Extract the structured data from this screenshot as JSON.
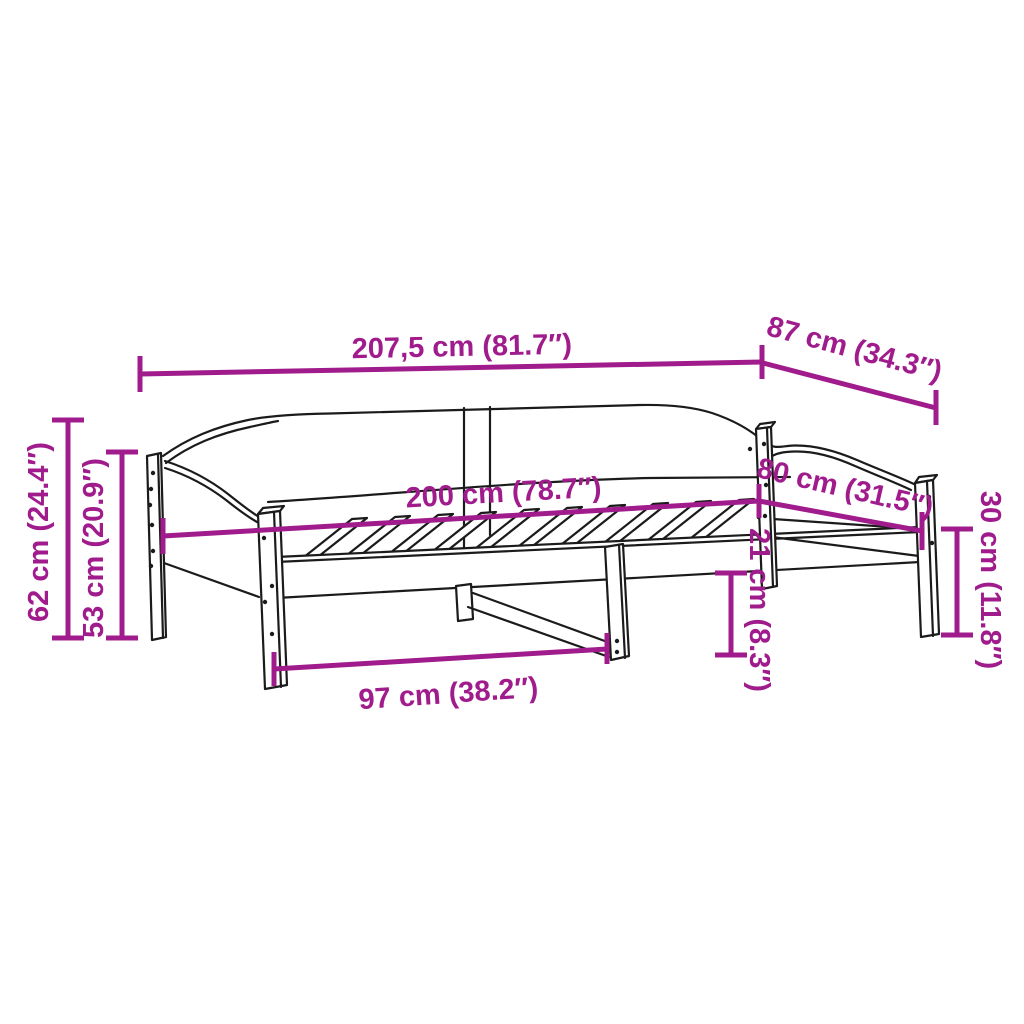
{
  "diagram": {
    "kind": "furniture-dimension-diagram",
    "subject": "daybed frame with slatted base",
    "colors": {
      "dimension_accent": "#A01B8C",
      "outline": "#1b1b1b",
      "background": "#ffffff"
    },
    "dimensions": [
      {
        "id": "overall-length",
        "label": "207,5 cm (81.7″)"
      },
      {
        "id": "overall-depth",
        "label": "87 cm (34.3″)"
      },
      {
        "id": "overall-height",
        "label": "62 cm (24.4″)"
      },
      {
        "id": "side-panel-height",
        "label": "53 cm (20.9″)"
      },
      {
        "id": "sleeping-length",
        "label": "200 cm (78.7″)"
      },
      {
        "id": "sleeping-width",
        "label": "80 cm (31.5″)"
      },
      {
        "id": "leg-height",
        "label": "30 cm (11.8″)"
      },
      {
        "id": "under-bed-clearance",
        "label": "21 cm (8.3″)"
      },
      {
        "id": "support-span",
        "label": "97 cm (38.2″)"
      }
    ]
  }
}
